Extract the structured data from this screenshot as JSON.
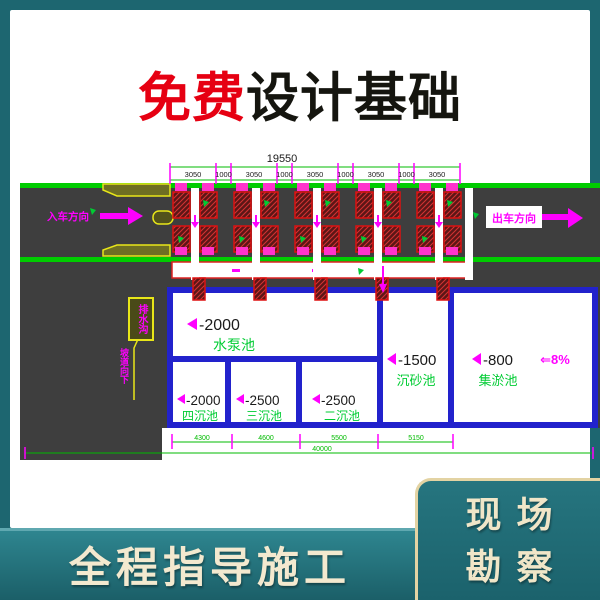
{
  "title": {
    "highlight": "免费",
    "rest": "设计基础"
  },
  "drawing": {
    "total_width_label": "19550",
    "dims_top": [
      "3050",
      "1000",
      "3050",
      "1000",
      "3050",
      "1000",
      "3050",
      "1000",
      "3050"
    ],
    "entry_label": "入车方向",
    "exit_label": "出车方向",
    "callout_box_label": "排水沟",
    "callout_leader_label": "坡道向下",
    "pools": {
      "pump": {
        "level": "-2000",
        "name": "水泵池"
      },
      "fourth": {
        "level": "-2000",
        "name": "四沉池"
      },
      "third": {
        "level": "-2500",
        "name": "三沉池"
      },
      "second": {
        "level": "-2500",
        "name": "二沉池"
      },
      "grit": {
        "level": "-1500",
        "name": "沉砂池"
      },
      "silt": {
        "level": "-800",
        "name": "集淤池"
      }
    },
    "slope_label": "⇐8%",
    "dims_bottom": [
      "4300",
      "4600",
      "5500",
      "5150"
    ],
    "total_bottom_label": "40000",
    "colors": {
      "background_teal": "#1d6670",
      "title_red": "#e60012",
      "annotation_magenta": "#ff00ff",
      "line_green": "#00cc00",
      "pool_wall_blue": "#2222cc",
      "road_gray": "#3e3e3e",
      "banner_cream": "#f3e9cf"
    }
  },
  "banner": {
    "text": "全程指导施工"
  },
  "side_badge": {
    "line1": "现场",
    "line2": "勘察"
  }
}
